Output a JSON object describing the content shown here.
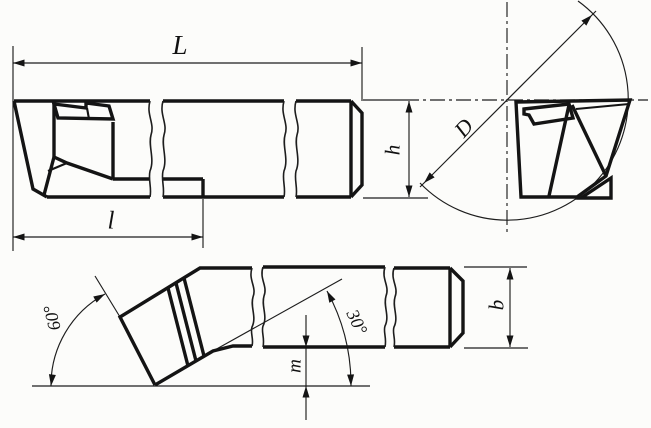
{
  "drawing": {
    "kind": "engineering-drawing: bent-shank brazed-tip turning tool, three orthographic views",
    "labels": {
      "overall_length": "L",
      "head_length": "l",
      "diameter": "D",
      "shank_height": "h",
      "shank_width": "b",
      "tip_offset": "m",
      "lead_angle": "60°",
      "bend_angle": "30°"
    },
    "colors": {
      "ink": "#141414",
      "paper": "#fcfcfa"
    }
  }
}
